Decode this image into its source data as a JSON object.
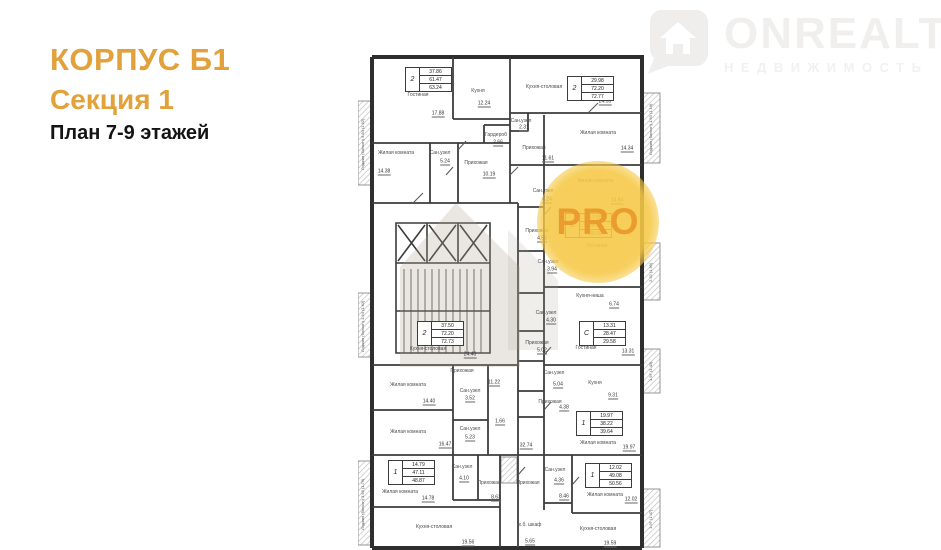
{
  "header": {
    "building": "КОРПУС Б1",
    "section": "Секция 1",
    "plan_title": "План 7-9 этажей",
    "accent_color": "#e2a13b"
  },
  "logo": {
    "name": "ONREALT",
    "subtitle": "НЕДВИЖИМОСТЬ",
    "icon": "house-pin-icon",
    "color": "#f0efed"
  },
  "watermark": {
    "pro_label": "PRO",
    "circle_color": "#f6c845",
    "text_color": "#e99a2c"
  },
  "floor_plan": {
    "spec_boxes": [
      {
        "type": "2",
        "areas": [
          "37.86",
          "61.47",
          "63.24"
        ],
        "x": 47,
        "y": 12
      },
      {
        "type": "2",
        "areas": [
          "29.98",
          "72.20",
          "72.77"
        ],
        "x": 209,
        "y": 21
      },
      {
        "type": "С",
        "areas": [
          "17.55",
          "28.28",
          "29.19"
        ],
        "x": 207,
        "y": 158
      },
      {
        "type": "2",
        "areas": [
          "37.50",
          "72.20",
          "72.73"
        ],
        "x": 59,
        "y": 266
      },
      {
        "type": "С",
        "areas": [
          "13.31",
          "28.47",
          "29.58"
        ],
        "x": 221,
        "y": 266
      },
      {
        "type": "1",
        "areas": [
          "19.97",
          "38.22",
          "39.64"
        ],
        "x": 218,
        "y": 356
      },
      {
        "type": "1",
        "areas": [
          "14.79",
          "47.11",
          "48.87"
        ],
        "x": 30,
        "y": 405
      },
      {
        "type": "1",
        "areas": [
          "12.02",
          "49.08",
          "50.56"
        ],
        "x": 227,
        "y": 408
      }
    ],
    "rooms": [
      {
        "label": "Гостиная",
        "x": 60,
        "y": 40,
        "area": "17.88",
        "ax": 80,
        "ay": 59
      },
      {
        "label": "Кухня",
        "x": 120,
        "y": 36,
        "area": "12.24",
        "ax": 126,
        "ay": 49
      },
      {
        "label": "Жилая комната",
        "x": 38,
        "y": 98,
        "area": "14.38",
        "ax": 26,
        "ay": 117
      },
      {
        "label": "Сан.узел",
        "x": 82,
        "y": 98,
        "area": "5.24",
        "ax": 87,
        "ay": 107
      },
      {
        "label": "Гардероб",
        "x": 138,
        "y": 80,
        "area": "2.66",
        "ax": 140,
        "ay": 88
      },
      {
        "label": "Прихожая",
        "x": 118,
        "y": 108,
        "area": "10.19",
        "ax": 131,
        "ay": 120
      },
      {
        "label": "Кухня-столовая",
        "x": 186,
        "y": 32,
        "area": "24.55",
        "ax": 247,
        "ay": 47
      },
      {
        "label": "Жилая комната",
        "x": 240,
        "y": 78,
        "area": "14.34",
        "ax": 269,
        "ay": 94
      },
      {
        "label": "Сан.узел",
        "x": 163,
        "y": 66,
        "area": "2.31",
        "ax": 166,
        "ay": 73
      },
      {
        "label": "Прихожая",
        "x": 176,
        "y": 93,
        "area": "11.61",
        "ax": 190,
        "ay": 104
      },
      {
        "label": "Жилая комната",
        "x": 237,
        "y": 126,
        "area": "13.84",
        "ax": 259,
        "ay": 146
      },
      {
        "label": "Сан.узел",
        "x": 185,
        "y": 136,
        "area": "4.24",
        "ax": 189,
        "ay": 145
      },
      {
        "label": "Прихожая",
        "x": 179,
        "y": 176,
        "area": "4.53",
        "ax": 184,
        "ay": 184
      },
      {
        "label": "Гостиная",
        "x": 239,
        "y": 191
      },
      {
        "label": "Сан.узел",
        "x": 190,
        "y": 207,
        "area": "3.94",
        "ax": 194,
        "ay": 215
      },
      {
        "label": "Кухня-ниша",
        "x": 232,
        "y": 241,
        "area": "6.74",
        "ax": 256,
        "ay": 250
      },
      {
        "label": "Сан.узел",
        "x": 188,
        "y": 258,
        "area": "4.30",
        "ax": 193,
        "ay": 266
      },
      {
        "label": "Прихожая",
        "x": 179,
        "y": 288,
        "area": "5.02",
        "ax": 184,
        "ay": 296
      },
      {
        "label": "Гостиная",
        "x": 228,
        "y": 293,
        "area": "13.31",
        "ax": 270,
        "ay": 297
      },
      {
        "label": "Кухня",
        "x": 237,
        "y": 328,
        "area": "9.31",
        "ax": 255,
        "ay": 341
      },
      {
        "label": "Сан.узел",
        "x": 196,
        "y": 318,
        "area": "5.04",
        "ax": 200,
        "ay": 330
      },
      {
        "label": "Прихожая",
        "x": 192,
        "y": 347,
        "area": "4.38",
        "ax": 206,
        "ay": 353
      },
      {
        "label": "Жилая комната",
        "x": 240,
        "y": 388,
        "area": "19.97",
        "ax": 271,
        "ay": 393
      },
      {
        "label": "Сан.узел",
        "x": 197,
        "y": 415,
        "area": "4.36",
        "ax": 201,
        "ay": 426
      },
      {
        "label": "Прихожая",
        "x": 170,
        "y": 428,
        "area": "8.46",
        "ax": 206,
        "ay": 442
      },
      {
        "label": "Жилая комната",
        "x": 247,
        "y": 440,
        "area": "12.02",
        "ax": 273,
        "ay": 445
      },
      {
        "label": "Кухня-столовая",
        "x": 240,
        "y": 474,
        "area": "19.59",
        "ax": 252,
        "ay": 489
      },
      {
        "label": "Жилая комната",
        "x": 42,
        "y": 437,
        "area": "14.78",
        "ax": 70,
        "ay": 444
      },
      {
        "label": "Сан.узел",
        "x": 104,
        "y": 412,
        "area": "4.10",
        "ax": 106,
        "ay": 424
      },
      {
        "label": "Прихожая",
        "x": 131,
        "y": 428,
        "area": "8.63",
        "ax": 138,
        "ay": 443
      },
      {
        "label": "Кухня-столовая",
        "x": 76,
        "y": 472,
        "area": "19.56",
        "ax": 110,
        "ay": 488
      },
      {
        "label": "х.б. шкаф",
        "x": 172,
        "y": 470,
        "area": "5.65",
        "ax": 172,
        "ay": 487
      },
      {
        "label": "Кухня-столовая",
        "x": 70,
        "y": 294,
        "area": "24.40",
        "ax": 112,
        "ay": 300
      },
      {
        "label": "Прихожая",
        "x": 104,
        "y": 316,
        "area": "11.22",
        "ax": 136,
        "ay": 328
      },
      {
        "label": "Жилая комната",
        "x": 50,
        "y": 330,
        "area": "14.40",
        "ax": 71,
        "ay": 347
      },
      {
        "label": "Сан.узел",
        "x": 112,
        "y": 336,
        "area": "3.52",
        "ax": 112,
        "ay": 344
      },
      {
        "label": "Жилая комната",
        "x": 50,
        "y": 377,
        "area": "16.47",
        "ax": 87,
        "ay": 390
      },
      {
        "label": "Сан.узел",
        "x": 112,
        "y": 374,
        "area": "5.23",
        "ax": 112,
        "ay": 383
      }
    ],
    "extra_values": [
      {
        "text": "32.74",
        "x": 168,
        "y": 391
      },
      {
        "text": "1.66",
        "x": 142,
        "y": 367
      }
    ],
    "balconies": [
      {
        "text": "Лоджия (балкон) 3.84 (1.92)",
        "x": 2,
        "y": 48,
        "h": 82
      },
      {
        "text": "Лоджия (балкон) 1.94 (1.63)",
        "x": 2,
        "y": 240,
        "h": 62
      },
      {
        "text": "Лоджия (балкон) 3.55 (1.76)",
        "x": 2,
        "y": 408,
        "h": 82
      },
      {
        "text": "Лоджия (балкон) 1.50 (1.16)",
        "x": 290,
        "y": 40,
        "h": 68
      },
      {
        "text": "2.32 (1.99)",
        "x": 290,
        "y": 190,
        "h": 55
      },
      {
        "text": "1.97 (1.43)",
        "x": 290,
        "y": 296,
        "h": 40
      },
      {
        "text": "1.97 (1.47)",
        "x": 290,
        "y": 436,
        "h": 56
      }
    ]
  }
}
